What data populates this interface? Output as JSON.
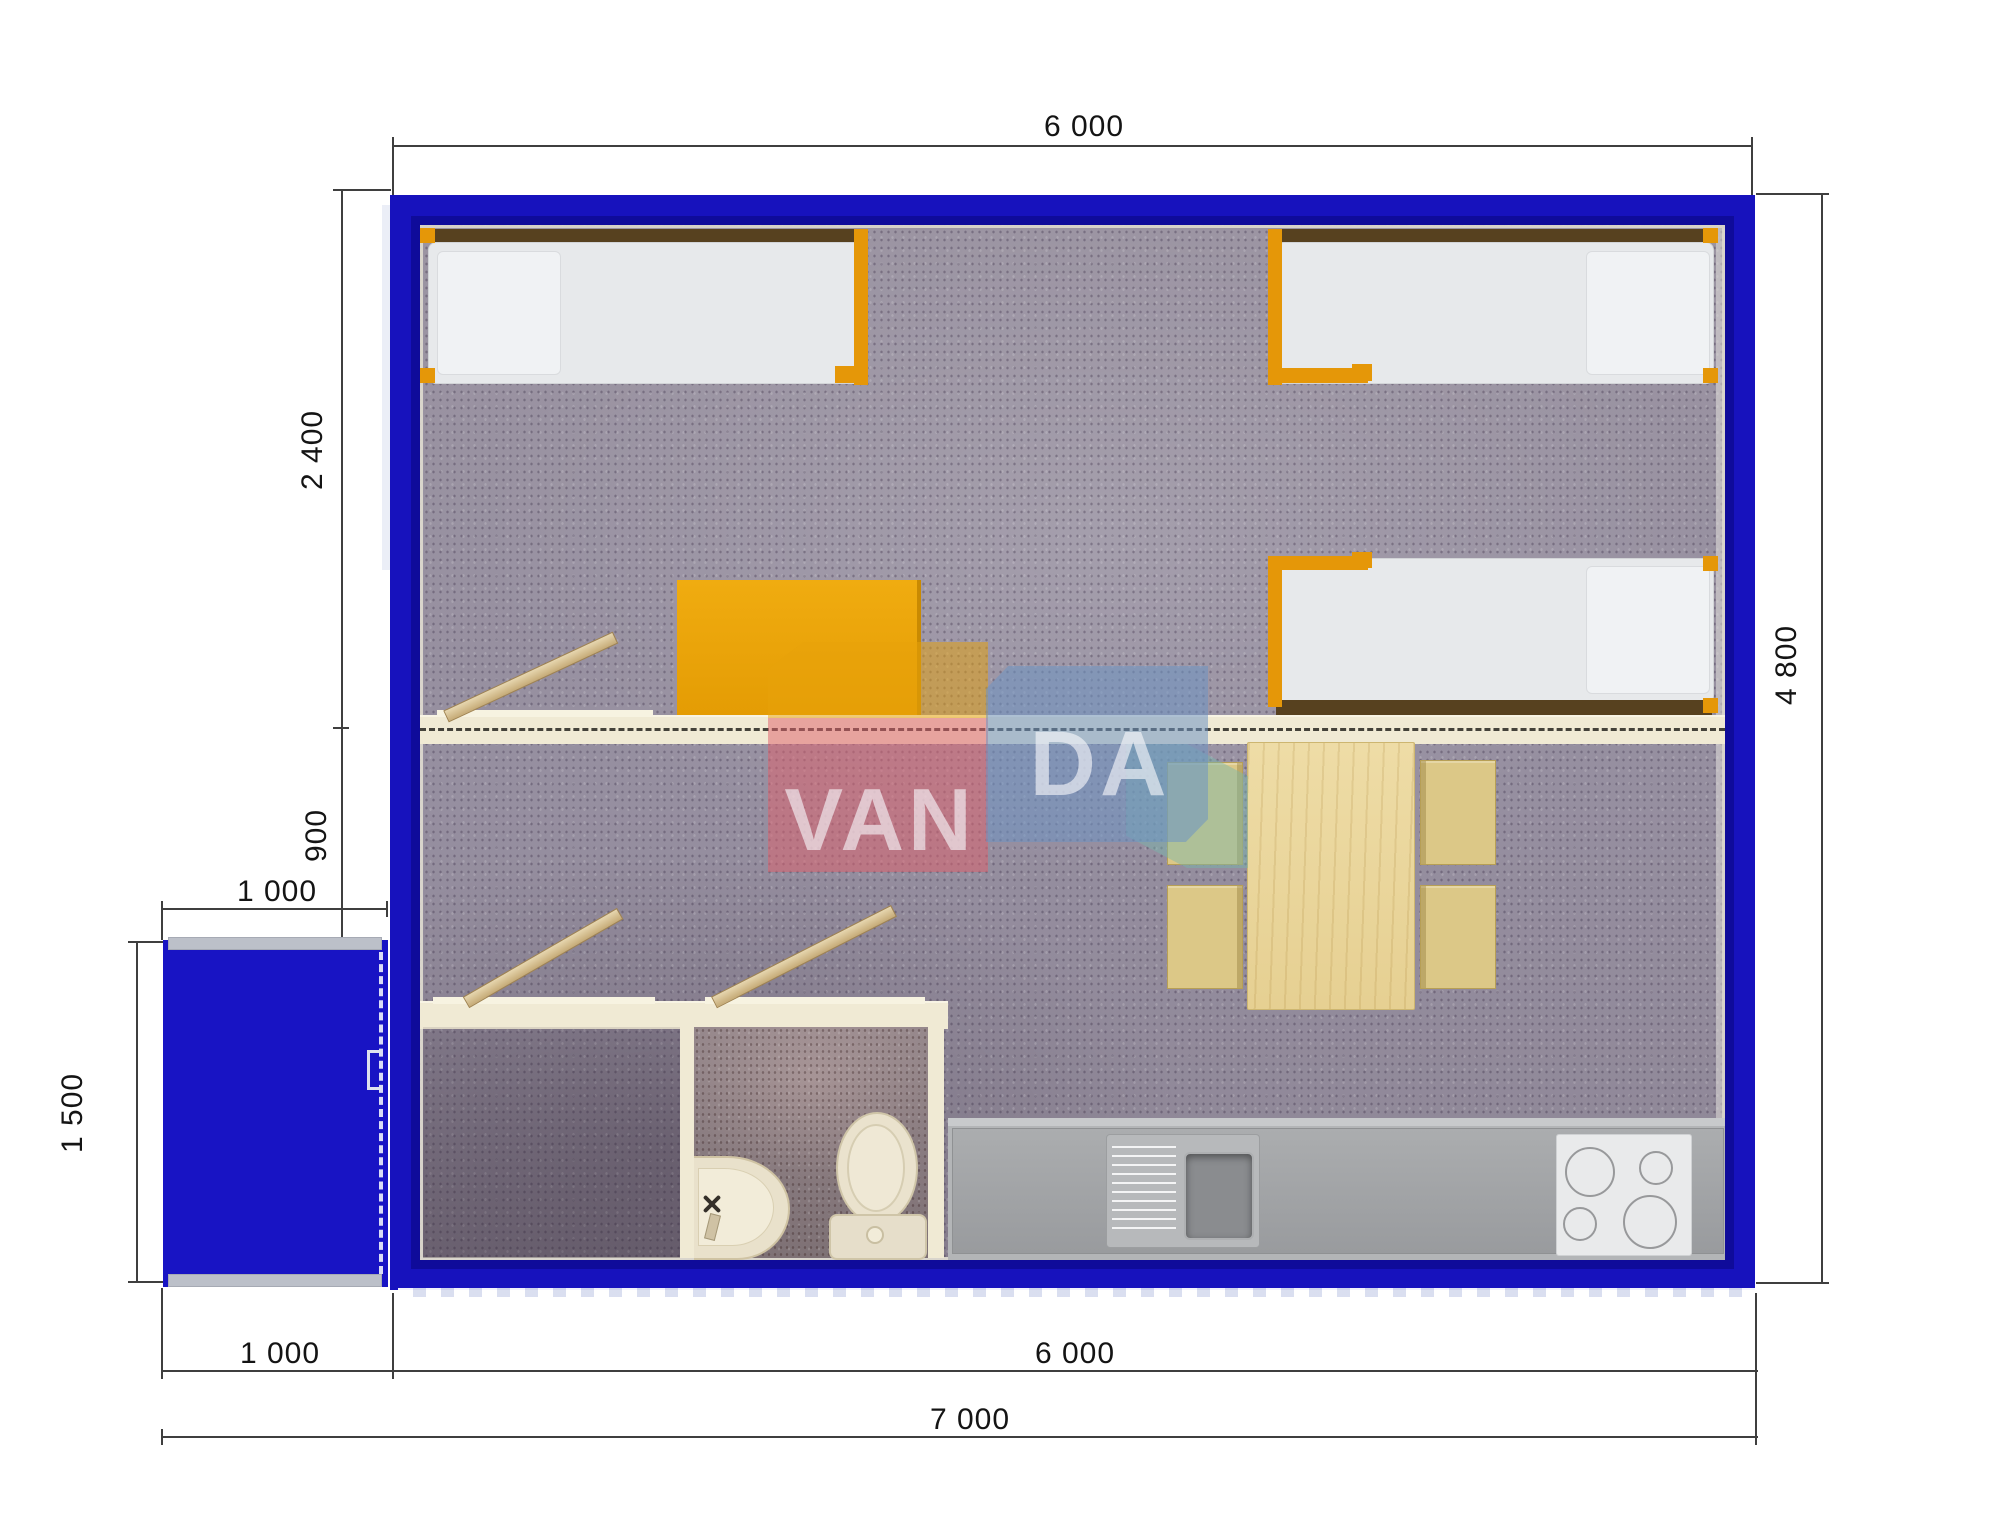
{
  "watermark": {
    "brand": "VANDA",
    "left_letters": "VAN",
    "right_letters": "DA"
  },
  "dimensions": {
    "top_width": "6 000",
    "bedroom_depth": "2 400",
    "middle_gap": "900",
    "porch_width_top": "1 000",
    "porch_depth": "1 500",
    "building_depth": "4 800",
    "porch_width_bottom": "1 000",
    "building_width_bottom": "6 000",
    "total_width": "7 000"
  },
  "colors": {
    "wall_blue": "#1712bd",
    "accent_orange": "#e59708",
    "desk_orange": "#eaa406",
    "wall_cream": "#f0ead4",
    "carpet_gray": "#968fa0",
    "counter_gray": "#a0a2a5",
    "pine_wood": "#ecd9a2",
    "chair_tan": "#dcc887",
    "watermark_red": "#df616e",
    "watermark_blue": "#6d93c3",
    "watermark_yellow": "#e7a20a",
    "watermark_teal": "#77b8ac"
  }
}
